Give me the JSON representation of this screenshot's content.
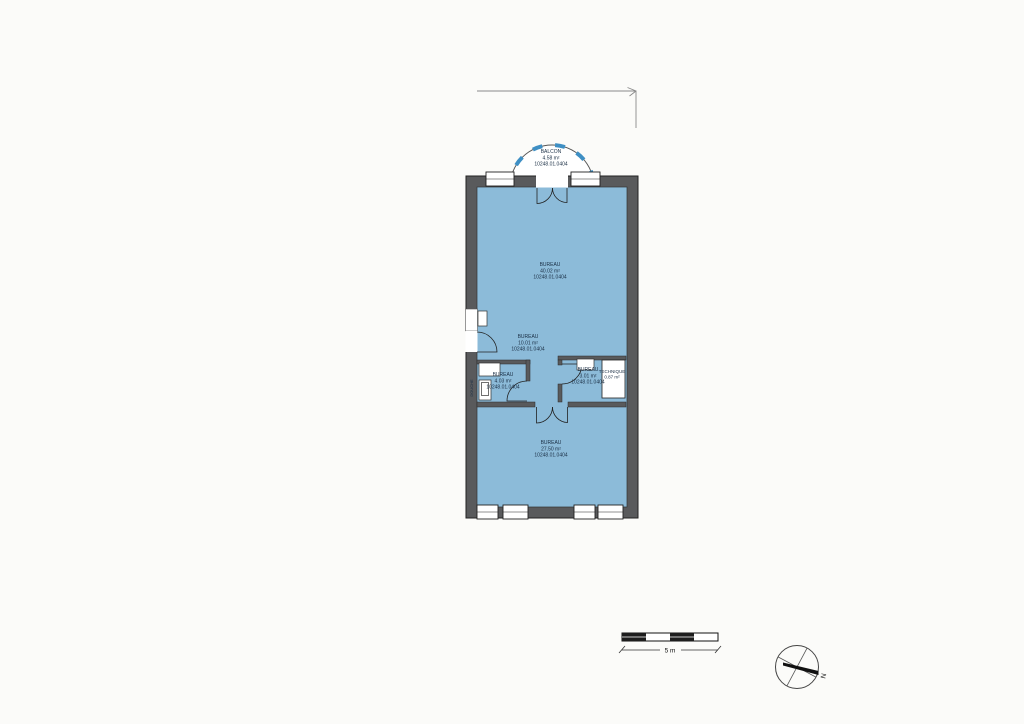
{
  "document": {
    "type": "architectural floor plan (scanned)",
    "background_color": "#fbfbf9"
  },
  "plan": {
    "colors": {
      "wall": "#595a5c",
      "floor": "#8cbbd9",
      "balcony_accent": "#3e8fc4",
      "label_text": "#1b2f45"
    },
    "rooms": {
      "balcon": {
        "name": "BALCON",
        "area": "4.58 m²",
        "code": "10248.01.0404"
      },
      "bureau_top": {
        "name": "BUREAU",
        "area": "40.02 m²",
        "code": "10248.01.0404"
      },
      "bureau_middle": {
        "name": "BUREAU",
        "area": "10.01 m²",
        "code": "10248.01.0404"
      },
      "bureau_left_small": {
        "name": "BUREAU",
        "area": "4.03 m²",
        "code": "10248.01.0404"
      },
      "bureau_right_small": {
        "name": "BUREAU",
        "area": "3.01 m²",
        "code": "10248.01.0404"
      },
      "technique": {
        "name": "TECHNIQUE",
        "area": "0.87 m²"
      },
      "bureau_bottom": {
        "name": "BUREAU",
        "area": "27.50 m²",
        "code": "10248.01.0404"
      },
      "douche": {
        "name": "DOUCHE"
      }
    }
  },
  "scale_bar": {
    "label": "5 m"
  },
  "compass": {
    "north_label": "N"
  }
}
